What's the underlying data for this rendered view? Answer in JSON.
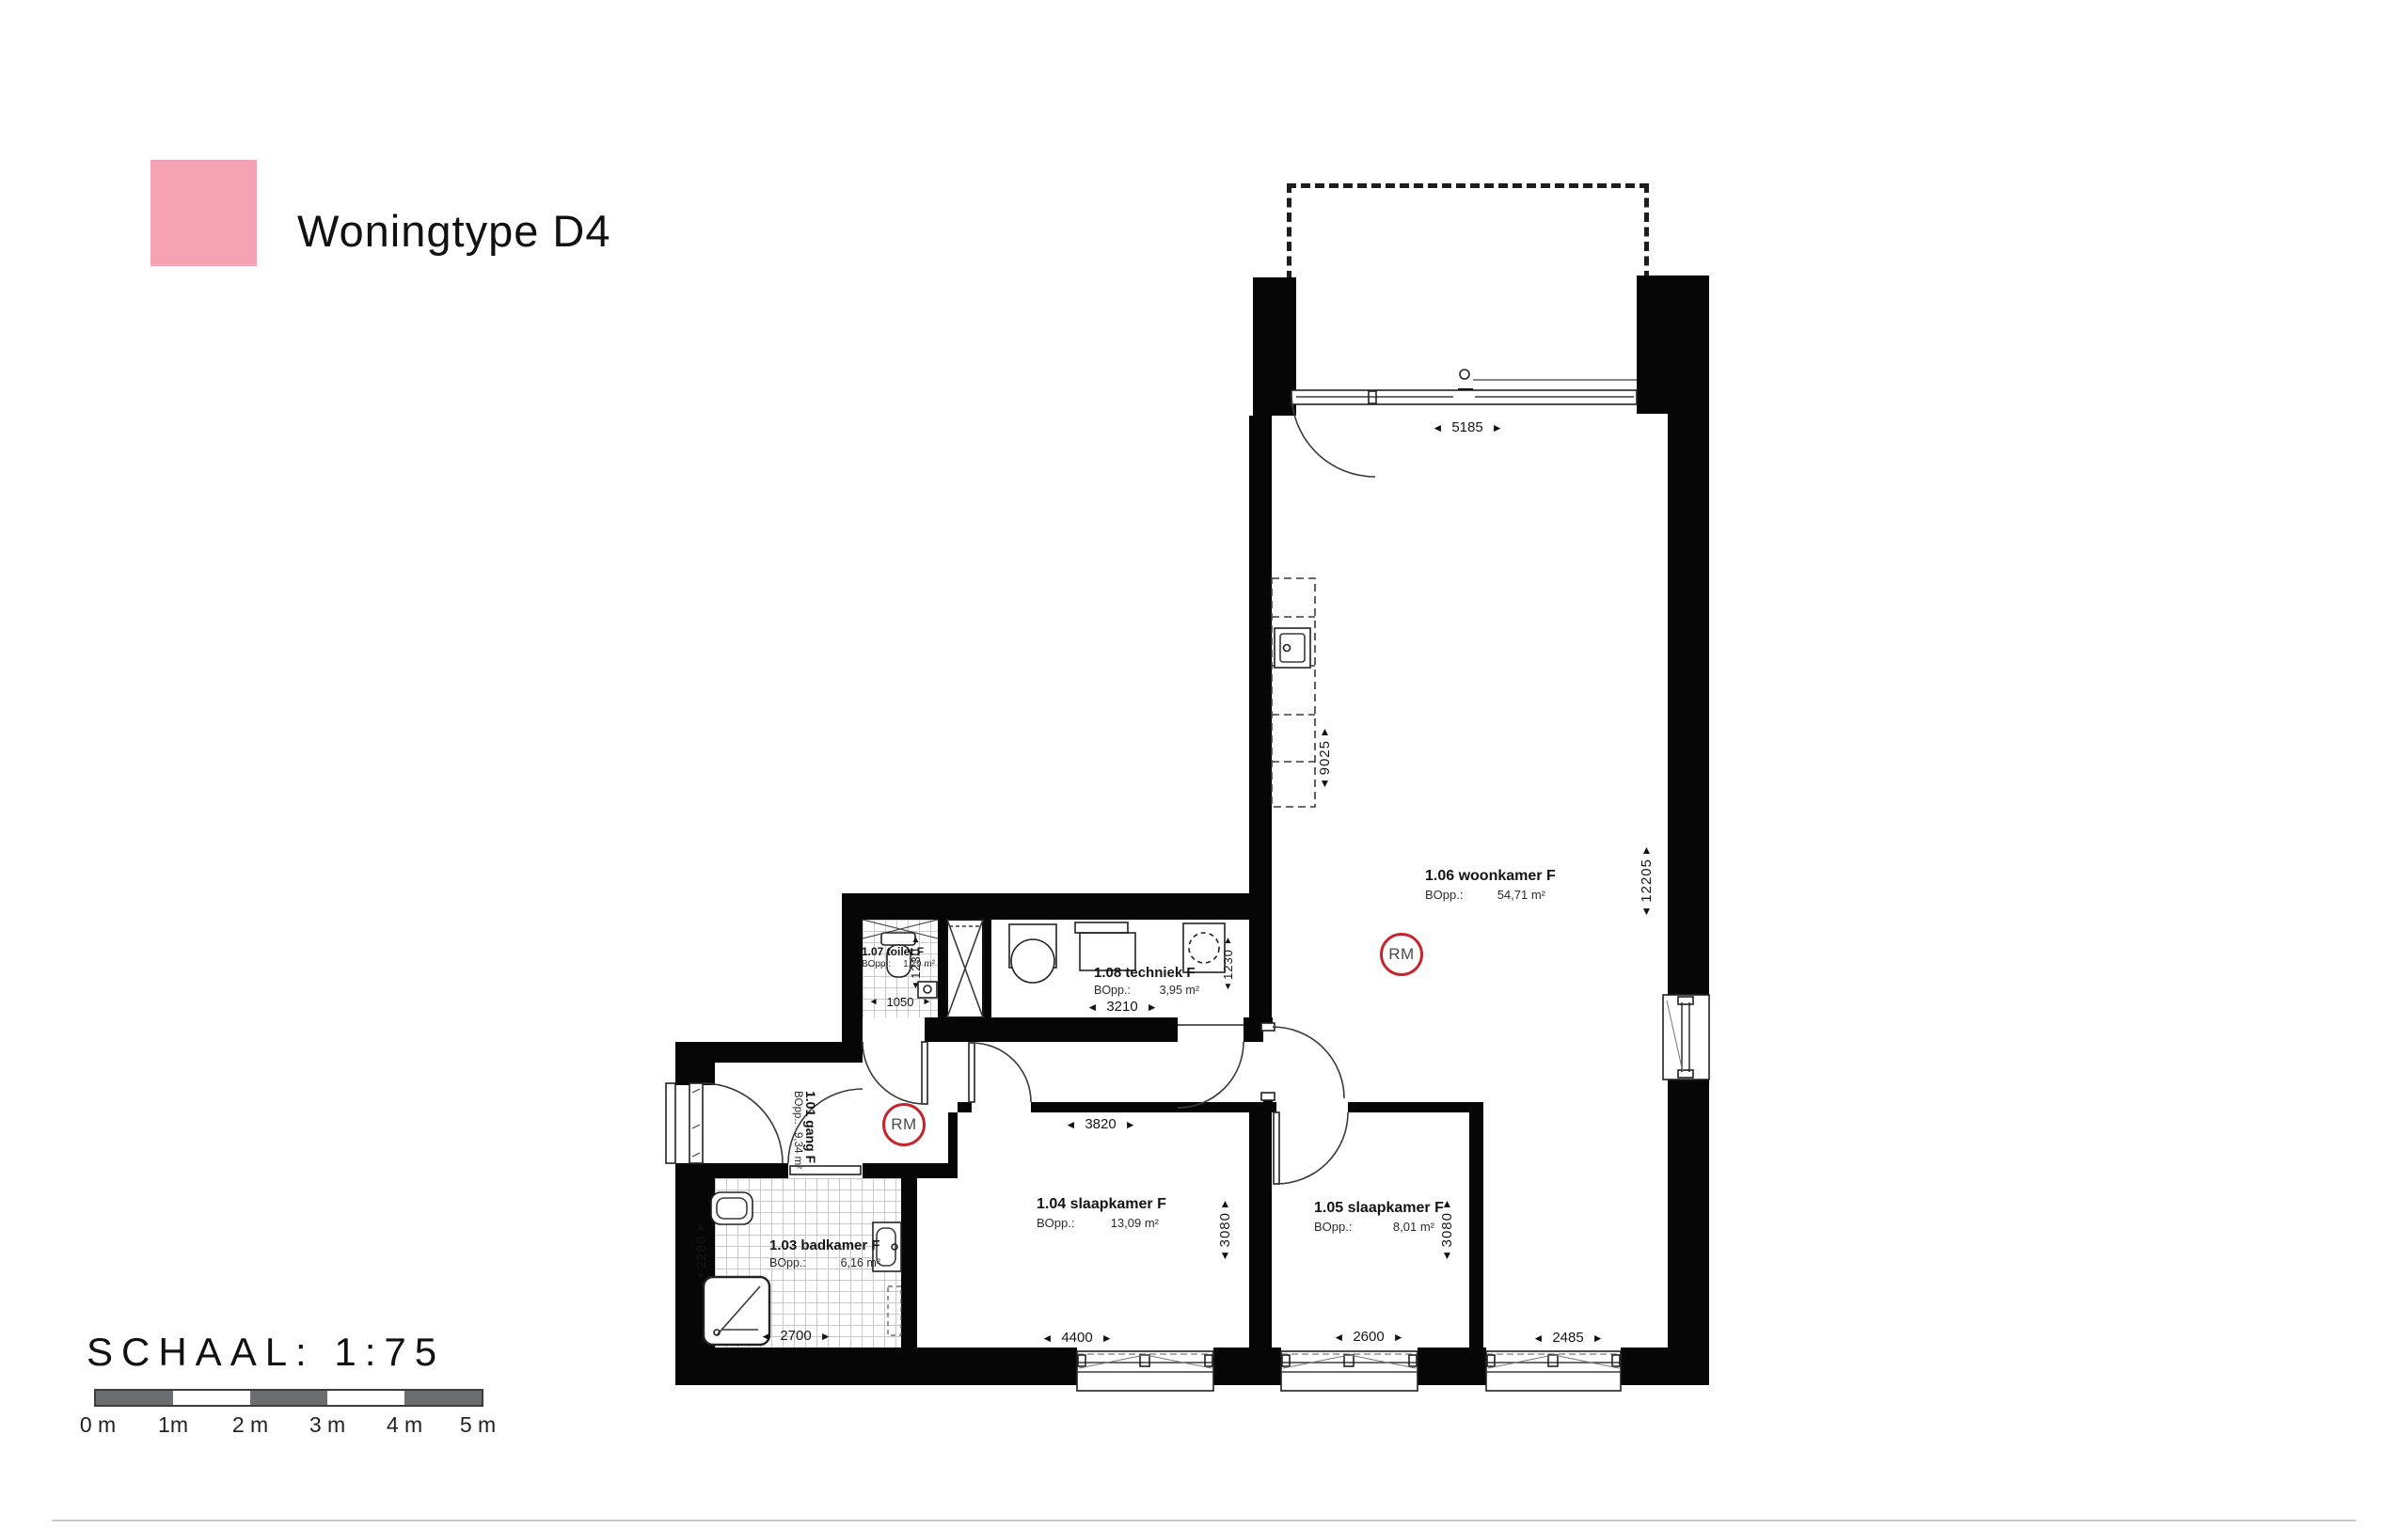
{
  "legend": {
    "title": "Woningtype D4",
    "color": "#F4A2B4"
  },
  "scale": {
    "label": "SCHAAL: 1:75",
    "ticks": [
      "0 m",
      "1m",
      "2 m",
      "3 m",
      "4 m",
      "5 m"
    ]
  },
  "labels": {
    "bopp": "BOpp.:",
    "rm": "RM"
  },
  "rooms": {
    "gang": {
      "name": "1.01 gang F",
      "area": "9,34 m²"
    },
    "badkamer": {
      "name": "1.03 badkamer F",
      "area": "6,16 m²"
    },
    "slaap104": {
      "name": "1.04 slaapkamer F",
      "area": "13,09 m²"
    },
    "slaap105": {
      "name": "1.05 slaapkamer F",
      "area": "8,01 m²"
    },
    "woonkamer": {
      "name": "1.06 woonkamer F",
      "area": "54,71 m²"
    },
    "toilet": {
      "name": "1.07 toilet F",
      "area": "1,29 m²"
    },
    "techniek": {
      "name": "1.08 techniek F",
      "area": "3,95 m²"
    }
  },
  "dims": {
    "living_top_w": "5185",
    "kitchen_len": "9025",
    "living_right_h": "12205",
    "toilet_w": "1050",
    "toilet_d": "1230",
    "techniek_w": "3210",
    "techniek_d": "1230",
    "hall_w": "3820",
    "slaap104_h": "3080",
    "slaap105_h": "3080",
    "slaap104_w": "4400",
    "slaap105_w": "2600",
    "living_win_w": "2485",
    "badkamer_w": "2700",
    "badkamer_h": "2280"
  }
}
